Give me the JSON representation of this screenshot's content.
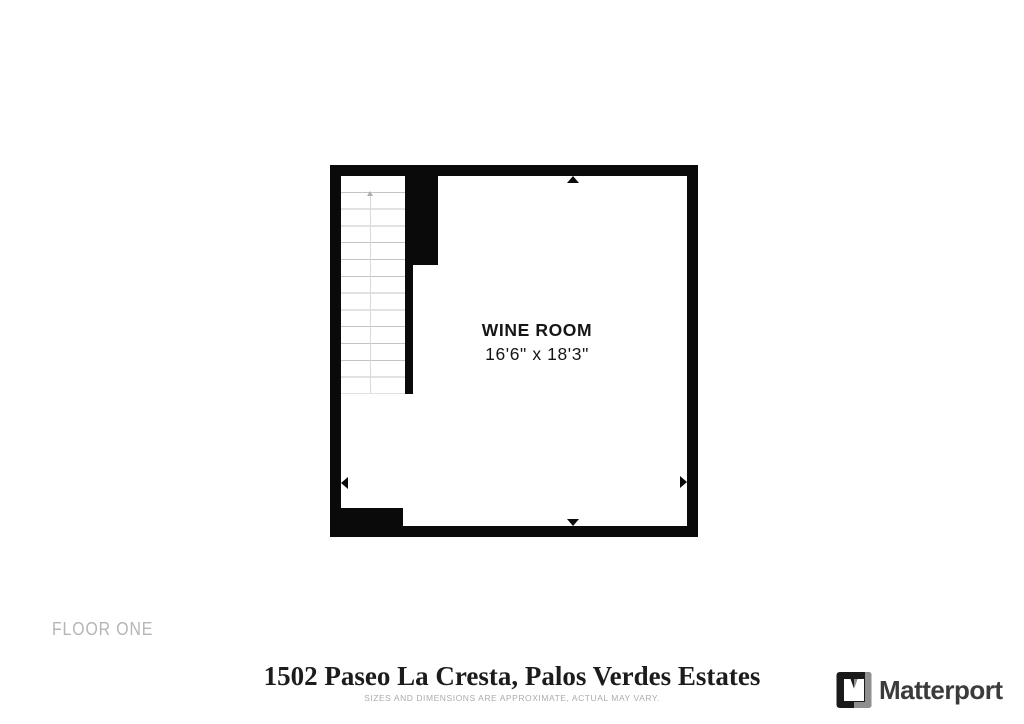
{
  "plan": {
    "room_label": "WINE ROOM",
    "room_dimensions": "16'6\" x 18'3\""
  },
  "floor_label": "FLOOR ONE",
  "footer": {
    "address": "1502 Paseo La Cresta, Palos Verdes Estates",
    "disclaimer": "SIZES AND DIMENSIONS ARE APPROXIMATE, ACTUAL MAY VARY.",
    "brand_name": "Matterport"
  },
  "colors": {
    "wall": "#0a0a0a",
    "stair_tread_line": "#c4c4c4",
    "floor_label_text": "#b4b4b4",
    "address_text": "#1c1c1c",
    "disclaimer_text": "#acacac",
    "brand_text": "#3b3b3b",
    "brand_gray": "#8f8f8f"
  }
}
